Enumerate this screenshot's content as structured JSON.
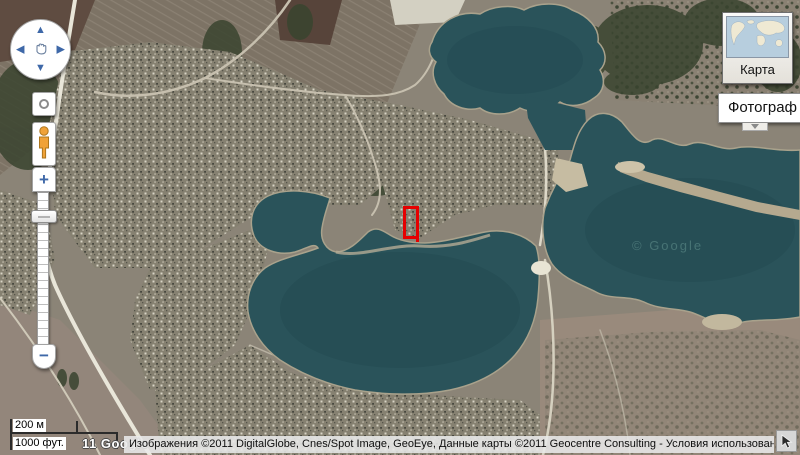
{
  "map": {
    "description": "satellite imagery of a lakeside village",
    "watermark": "© Google",
    "marker_color": "#e60000"
  },
  "controls": {
    "pan_up": "▲",
    "pan_down": "▼",
    "pan_left": "◀",
    "pan_right": "▶",
    "zoom_in": "+",
    "zoom_out": "−"
  },
  "map_type": {
    "map_label": "Карта",
    "photo_label": "Фотограф"
  },
  "scale": {
    "metric": "200 м",
    "imperial": "1000 фут."
  },
  "google_logo": "11 Google",
  "attribution": {
    "text": "Изображения ©2011 DigitalGlobe, Cnes/Spot Image, GeoEye, Данные карты ©2011 Geocentre Consulting - ",
    "terms": "Условия использования"
  },
  "icons": {
    "pan_hand": "grab-hand",
    "reset_view": "circle-ring",
    "street_view": "pegman-figure",
    "dropdown": "chevron-down",
    "cursor": "nw-arrow"
  },
  "colors": {
    "water": "#2a535a",
    "accent_blue": "#3e68a8",
    "marker_red": "#e60000"
  }
}
